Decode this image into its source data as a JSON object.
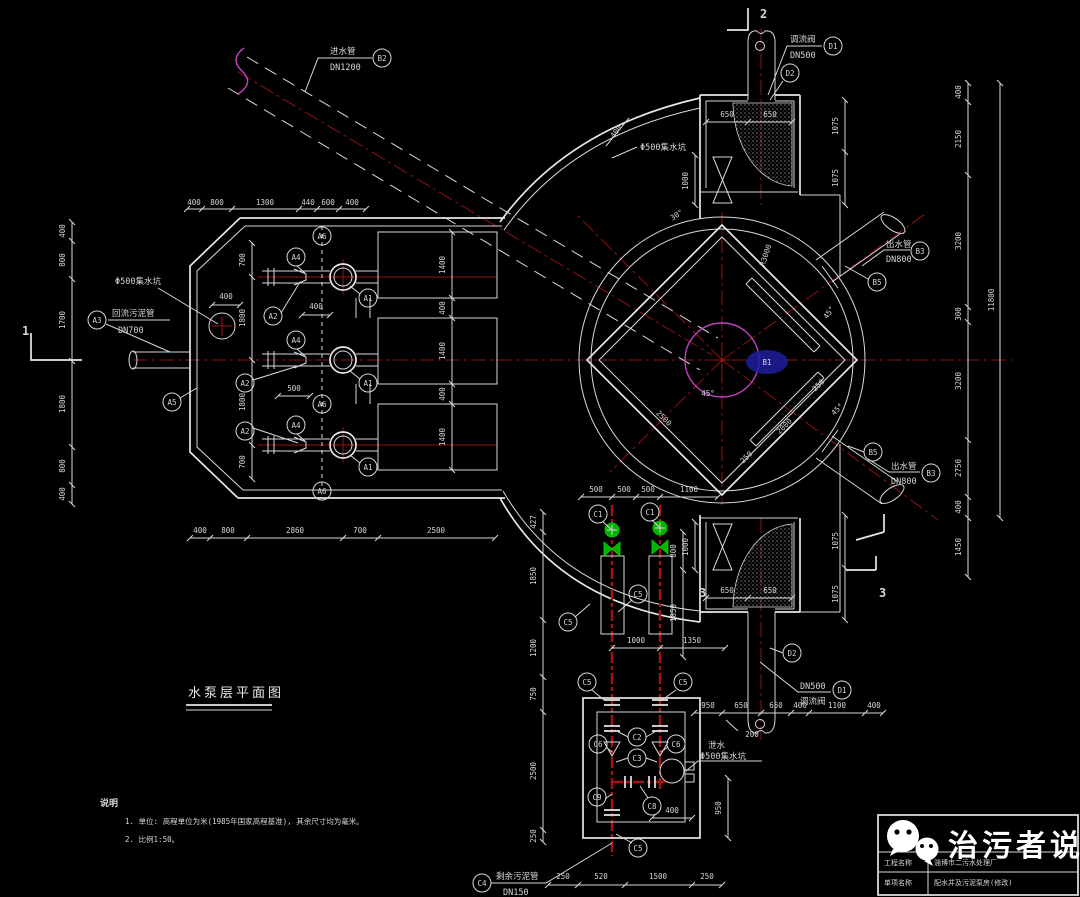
{
  "title": {
    "text": "水泵层平面图"
  },
  "notes": {
    "heading": "说明",
    "n1": "1. 单位: 高程单位为米(1985年国家高程基准), 其余尺寸均为毫米。",
    "n2": "2. 比例1:50。"
  },
  "brand": {
    "name": "治污者说",
    "row1_label": "工程名称",
    "row1_value": "淄博市二污水处理厂",
    "row2_label": "单项名称",
    "row2_value": "配水井及污泥泵房(修改)"
  },
  "balloons": {
    "a1": "A1",
    "a2": "A2",
    "a3": "A3",
    "a4": "A4",
    "a5": "A5",
    "a6": "A6",
    "b1": "B1",
    "b2": "B2",
    "b3": "B3",
    "b5": "B5",
    "c1": "C1",
    "c2": "C2",
    "c3": "C3",
    "c4": "C4",
    "c5": "C5",
    "c6": "C6",
    "c8": "C8",
    "c9": "C9",
    "d1": "D1",
    "d2": "D2"
  },
  "sections": {
    "s1": "1",
    "s2": "2",
    "s3": "3"
  },
  "angles": {
    "deg30": "30°",
    "deg45": "45°"
  },
  "radius": {
    "r": "R3000"
  },
  "pipe_labels": {
    "inlet_name": "进水管",
    "inlet_dn": "DN1200",
    "return_name": "回流污泥管",
    "return_dn": "DN700",
    "outlet_name": "出水管",
    "outlet_dn": "DN800",
    "valve_name": "调流阀",
    "valve_dn": "DN500",
    "surplus_name": "剩余污泥管",
    "surplus_dn": "DN150",
    "sump": "Φ500集水坑",
    "drain": "泄水"
  },
  "dims": {
    "top": [
      "400",
      "800",
      "1300",
      "440",
      "600",
      "400"
    ],
    "left": [
      "400",
      "800",
      "1700",
      "1800",
      "800",
      "400"
    ],
    "bottom": [
      "400",
      "800",
      "2860",
      "700",
      "2500"
    ],
    "inner_v": [
      "700",
      "1800",
      "1800",
      "700"
    ],
    "bays": [
      "1400",
      "400",
      "1400",
      "400",
      "1400"
    ],
    "sump_offset": "400",
    "pump_gap": "500",
    "grid_offset": "400",
    "sump_top_offset": "400",
    "chamber_w": [
      "650",
      "650"
    ],
    "chamber_h": [
      "1075",
      "1075"
    ],
    "valve_h": "1000",
    "right": [
      "400",
      "2150",
      "3200",
      "300",
      "3200",
      "2750",
      "400"
    ],
    "right_total": "11800",
    "right_bottom": "1450",
    "well": {
      "side": "2500",
      "side2": "2000",
      "off": "250",
      "off2": "250"
    },
    "mid_top": [
      "500",
      "500",
      "500",
      "1100"
    ],
    "mid_v": [
      "800",
      "1850"
    ],
    "mid_bottom": [
      "1000",
      "1350"
    ],
    "mid_left": [
      "427",
      "1850",
      "1200",
      "750",
      "2500",
      "250"
    ],
    "pit_inner": "400",
    "pit_right": "950",
    "pit_note": "200",
    "pit_bottom": [
      "250",
      "520",
      "1500",
      "250"
    ],
    "br": [
      "950",
      "650",
      "650",
      "400",
      "1100",
      "400"
    ]
  }
}
